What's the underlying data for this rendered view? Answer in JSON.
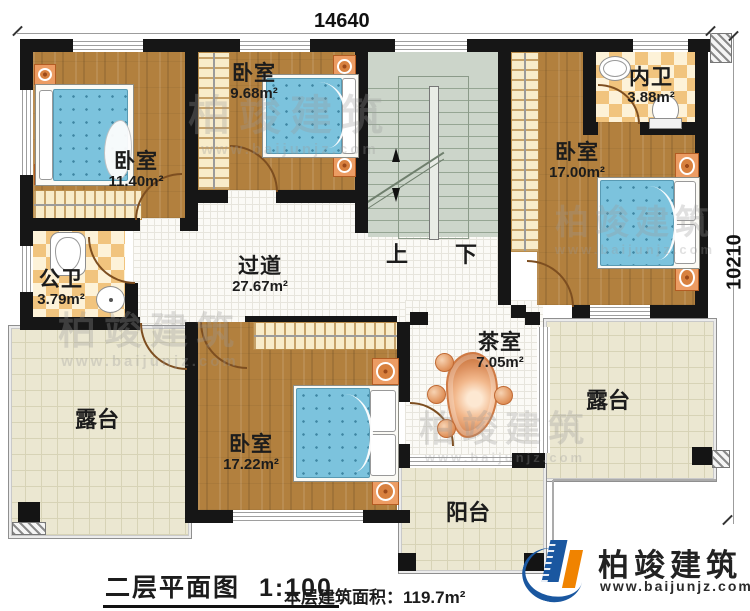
{
  "dimensions": {
    "top": "14640",
    "right": "10210"
  },
  "rooms": {
    "bedroom_tl": {
      "name": "卧室",
      "area": "11.40m²"
    },
    "bedroom_tc": {
      "name": "卧室",
      "area": "9.68m²"
    },
    "bath_inner": {
      "name": "内卫",
      "area": "3.88m²"
    },
    "bedroom_r": {
      "name": "卧室",
      "area": "17.00m²"
    },
    "bath_public": {
      "name": "公卫",
      "area": "3.79m²"
    },
    "hallway": {
      "name": "过道",
      "area": "27.67m²"
    },
    "tea_room": {
      "name": "茶室",
      "area": "7.05m²"
    },
    "bedroom_b": {
      "name": "卧室",
      "area": "17.22m²"
    },
    "terrace_left": {
      "name": "露台"
    },
    "terrace_right": {
      "name": "露台"
    },
    "balcony": {
      "name": "阳台"
    }
  },
  "stairs": {
    "up": "上",
    "down": "下"
  },
  "footer": {
    "title": "二层平面图",
    "scale": "1:100",
    "area_label": "本层建筑面积：",
    "area_value": "119.7m²"
  },
  "logo": {
    "name": "柏竣建筑",
    "url": "www.baijunjz.com"
  },
  "watermark": {
    "name": "柏竣建筑",
    "url": "www.baijunjz.com"
  }
}
